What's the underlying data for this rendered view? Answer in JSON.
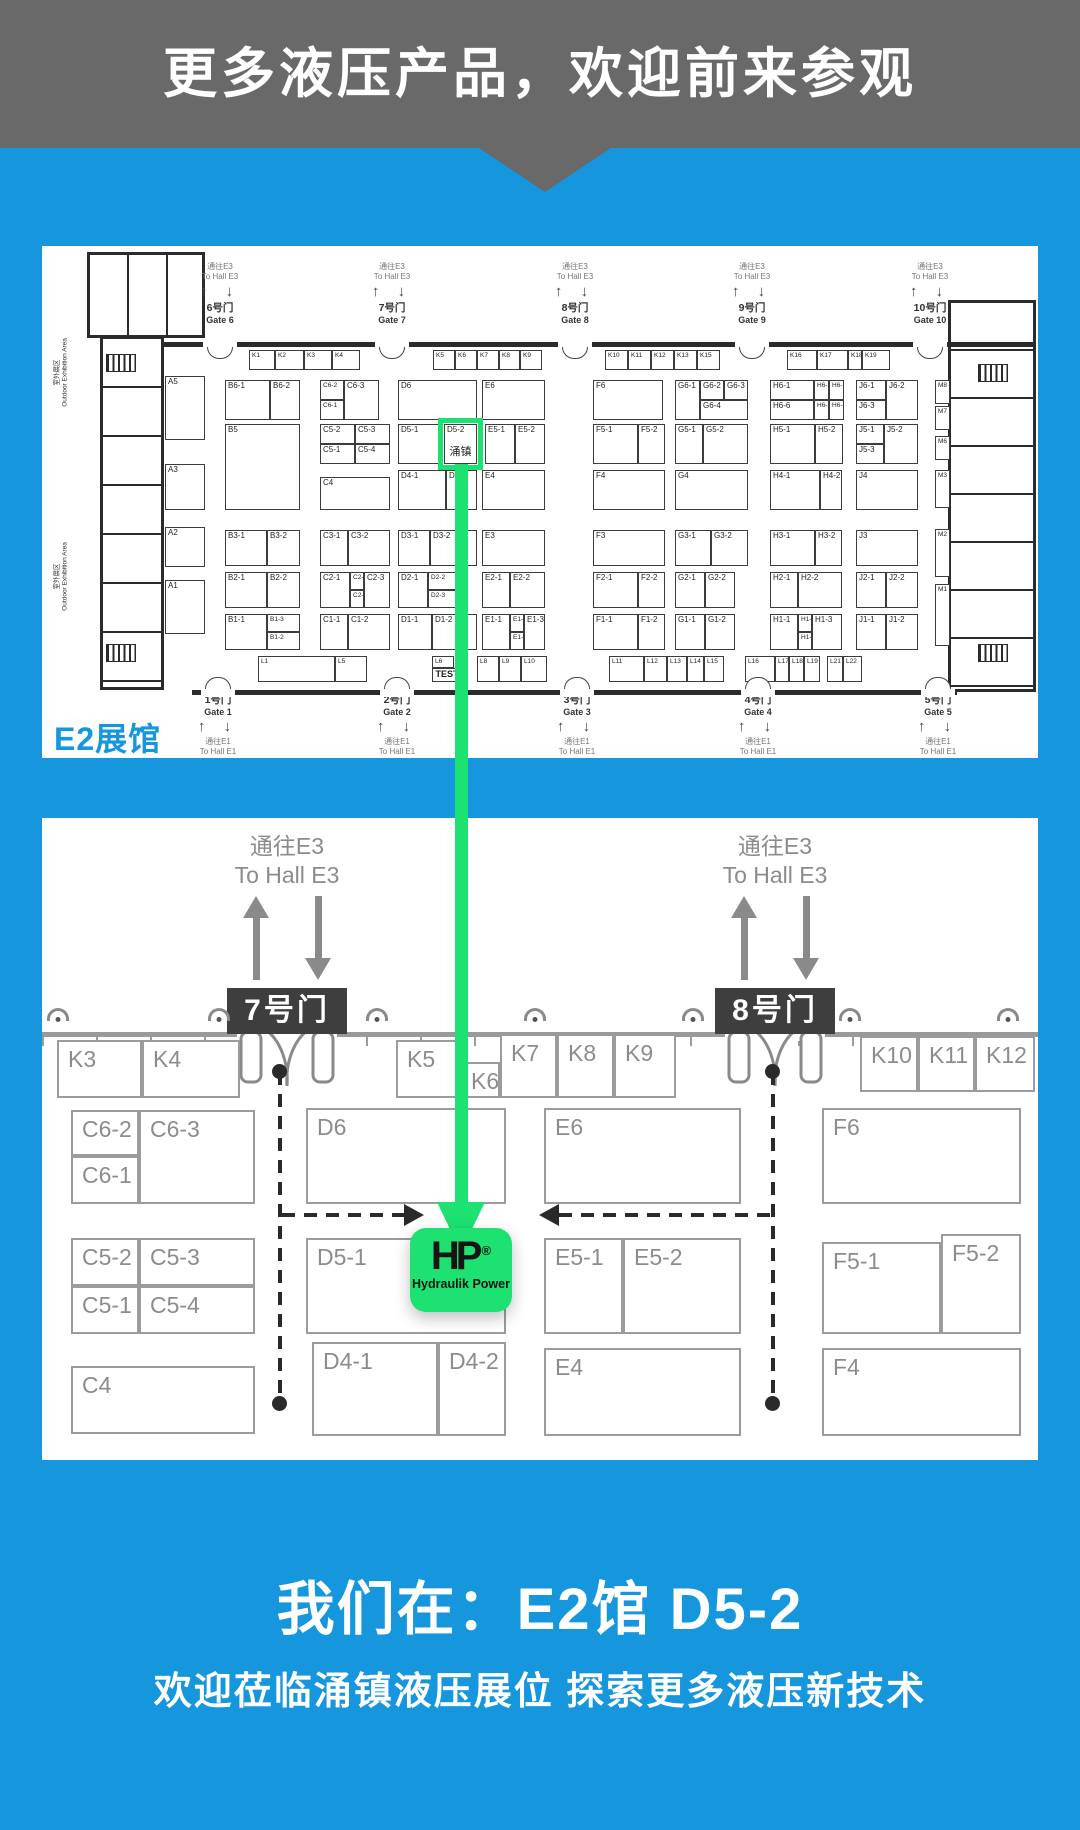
{
  "colors": {
    "blue": "#1596DD",
    "gray": "#696969",
    "green": "#1DE171",
    "dark": "#3E3E3E"
  },
  "banner": {
    "title": "更多液压产品，欢迎前来参观"
  },
  "footer": {
    "line1": "我们在：E2馆 D5-2",
    "line2": "欢迎莅临涌镇液压展位  探索更多液压新技术"
  },
  "booth_format": "label,x,y,w,h,class,sublabel",
  "hall_map": {
    "hall_label": "E2展馆",
    "outdoor": {
      "cn": "室外展区",
      "en": "Outdoor Exhibition Area"
    },
    "to_hall_top": {
      "cn": "通往E3",
      "en": "To Hall E3"
    },
    "to_hall_bottom": {
      "cn": "通往E1",
      "en": "To Hall E1"
    },
    "gates_top": [
      {
        "cn": "6号门",
        "en": "Gate 6",
        "x": 178
      },
      {
        "cn": "7号门",
        "en": "Gate 7",
        "x": 350
      },
      {
        "cn": "8号门",
        "en": "Gate 8",
        "x": 533
      },
      {
        "cn": "9号门",
        "en": "Gate 9",
        "x": 710
      },
      {
        "cn": "10号门",
        "en": "Gate 10",
        "x": 888
      }
    ],
    "gates_bottom": [
      {
        "cn": "1号门",
        "en": "Gate 1",
        "x": 176
      },
      {
        "cn": "2号门",
        "en": "Gate 2",
        "x": 355
      },
      {
        "cn": "3号门",
        "en": "Gate 3",
        "x": 535
      },
      {
        "cn": "4号门",
        "en": "Gate 4",
        "x": 716
      },
      {
        "cn": "5号门",
        "en": "Gate 5",
        "x": 896
      }
    ],
    "booths": [
      [
        "A5",
        123,
        130,
        40,
        64
      ],
      [
        "A3",
        123,
        218,
        40,
        46
      ],
      [
        "A2",
        123,
        281,
        40,
        40
      ],
      [
        "A1",
        123,
        334,
        40,
        54
      ],
      [
        "B6-1",
        183,
        134,
        45,
        40
      ],
      [
        "B6-2",
        228,
        134,
        30,
        40
      ],
      [
        "B5",
        183,
        178,
        75,
        86
      ],
      [
        "B3-1",
        183,
        284,
        42,
        36
      ],
      [
        "B3-2",
        225,
        284,
        33,
        36
      ],
      [
        "B2-1",
        183,
        326,
        42,
        36
      ],
      [
        "B2-2",
        225,
        326,
        33,
        36
      ],
      [
        "B1-1",
        183,
        368,
        42,
        36
      ],
      [
        "B1-3",
        225,
        368,
        33,
        18,
        "s"
      ],
      [
        "B1-2",
        225,
        386,
        33,
        18,
        "s"
      ],
      [
        "C6-2",
        278,
        134,
        24,
        20,
        "s"
      ],
      [
        "C6-1",
        278,
        154,
        24,
        20,
        "s"
      ],
      [
        "C6-3",
        302,
        134,
        35,
        40
      ],
      [
        "C5-2",
        278,
        178,
        35,
        20
      ],
      [
        "C5-3",
        313,
        178,
        35,
        20
      ],
      [
        "C5-1",
        278,
        198,
        35,
        20
      ],
      [
        "C5-4",
        313,
        198,
        35,
        20
      ],
      [
        "C4",
        278,
        231,
        70,
        33
      ],
      [
        "C3-1",
        278,
        284,
        28,
        36
      ],
      [
        "C3-2",
        306,
        284,
        42,
        36
      ],
      [
        "C2-1",
        278,
        326,
        30,
        36
      ],
      [
        "C2-4",
        308,
        326,
        14,
        18,
        "s"
      ],
      [
        "C2-2",
        308,
        344,
        14,
        18,
        "s"
      ],
      [
        "C2-3",
        322,
        326,
        26,
        36
      ],
      [
        "C1-1",
        278,
        368,
        28,
        36
      ],
      [
        "C1-2",
        306,
        368,
        42,
        36
      ],
      [
        "D6",
        356,
        134,
        79,
        40
      ],
      [
        "D5-1",
        356,
        178,
        44,
        40
      ],
      [
        "D5-2",
        402,
        178,
        33,
        40,
        "hl",
        "涌镇"
      ],
      [
        "D4-1",
        356,
        224,
        48,
        40
      ],
      [
        "D4-2",
        404,
        224,
        31,
        40
      ],
      [
        "D3-1",
        356,
        284,
        32,
        36
      ],
      [
        "D3-2",
        388,
        284,
        47,
        36
      ],
      [
        "D2-1",
        356,
        326,
        30,
        36
      ],
      [
        "D2-2",
        386,
        326,
        28,
        18,
        "s"
      ],
      [
        "D2-3",
        386,
        344,
        28,
        18,
        "s"
      ],
      [
        "D1-1",
        356,
        368,
        34,
        36
      ],
      [
        "D1-2",
        390,
        368,
        45,
        36
      ],
      [
        "E6",
        440,
        134,
        63,
        40
      ],
      [
        "E5-1",
        443,
        178,
        30,
        40
      ],
      [
        "E5-2",
        473,
        178,
        30,
        40
      ],
      [
        "E4",
        440,
        224,
        63,
        40
      ],
      [
        "E3",
        440,
        284,
        63,
        36
      ],
      [
        "E2-1",
        440,
        326,
        28,
        36
      ],
      [
        "E2-2",
        468,
        326,
        35,
        36
      ],
      [
        "E1-1",
        440,
        368,
        28,
        36
      ],
      [
        "E1-2",
        468,
        368,
        14,
        18,
        "s"
      ],
      [
        "E1-4",
        468,
        386,
        14,
        18,
        "s"
      ],
      [
        "E1-3",
        482,
        368,
        21,
        36
      ],
      [
        "F6",
        551,
        134,
        70,
        40
      ],
      [
        "F5-1",
        551,
        178,
        45,
        40
      ],
      [
        "F5-2",
        596,
        178,
        27,
        40
      ],
      [
        "F4",
        551,
        224,
        72,
        40
      ],
      [
        "F3",
        551,
        284,
        72,
        36
      ],
      [
        "F2-1",
        551,
        326,
        45,
        36
      ],
      [
        "F2-2",
        596,
        326,
        27,
        36
      ],
      [
        "F1-1",
        551,
        368,
        45,
        36
      ],
      [
        "F1-2",
        596,
        368,
        27,
        36
      ],
      [
        "G6-1",
        633,
        134,
        25,
        40
      ],
      [
        "G6-2",
        658,
        134,
        24,
        20
      ],
      [
        "G6-3",
        682,
        134,
        24,
        20
      ],
      [
        "G6-4",
        658,
        154,
        48,
        20
      ],
      [
        "G5-1",
        633,
        178,
        28,
        40
      ],
      [
        "G5-2",
        661,
        178,
        45,
        40
      ],
      [
        "G4",
        633,
        224,
        73,
        40
      ],
      [
        "G3-1",
        633,
        284,
        36,
        36
      ],
      [
        "G3-2",
        669,
        284,
        37,
        36
      ],
      [
        "G2-1",
        633,
        326,
        30,
        36
      ],
      [
        "G2-2",
        663,
        326,
        30,
        36
      ],
      [
        "G1-1",
        633,
        368,
        30,
        36
      ],
      [
        "G1-2",
        663,
        368,
        30,
        36
      ],
      [
        "H6-1",
        728,
        134,
        44,
        20
      ],
      [
        "H6-6",
        728,
        154,
        44,
        20
      ],
      [
        "H6-2",
        772,
        134,
        15,
        20,
        "s"
      ],
      [
        "H6-3",
        787,
        134,
        15,
        20,
        "s"
      ],
      [
        "H6-5",
        772,
        154,
        15,
        20,
        "s"
      ],
      [
        "H6-4",
        787,
        154,
        15,
        20,
        "s"
      ],
      [
        "H5-1",
        728,
        178,
        45,
        40
      ],
      [
        "H5-2",
        773,
        178,
        28,
        40
      ],
      [
        "H4-1",
        728,
        224,
        50,
        40
      ],
      [
        "H4-2",
        778,
        224,
        22,
        40
      ],
      [
        "H3-1",
        728,
        284,
        45,
        36
      ],
      [
        "H3-2",
        773,
        284,
        27,
        36
      ],
      [
        "H2-1",
        728,
        326,
        28,
        36
      ],
      [
        "H2-2",
        756,
        326,
        44,
        36
      ],
      [
        "H1-1",
        728,
        368,
        28,
        36
      ],
      [
        "H1-2",
        756,
        368,
        14,
        18,
        "s"
      ],
      [
        "H1-4",
        756,
        386,
        14,
        18,
        "s"
      ],
      [
        "H1-3",
        770,
        368,
        30,
        36
      ],
      [
        "J6-1",
        814,
        134,
        30,
        20
      ],
      [
        "J6-3",
        814,
        154,
        30,
        20
      ],
      [
        "J6-2",
        844,
        134,
        32,
        40
      ],
      [
        "J5-1",
        814,
        178,
        28,
        20
      ],
      [
        "J5-3",
        814,
        198,
        28,
        20
      ],
      [
        "J5-2",
        842,
        178,
        34,
        40
      ],
      [
        "J4",
        814,
        224,
        62,
        40
      ],
      [
        "J3",
        814,
        284,
        62,
        36
      ],
      [
        "J2-1",
        814,
        326,
        30,
        36
      ],
      [
        "J2-2",
        844,
        326,
        32,
        36
      ],
      [
        "J1-1",
        814,
        368,
        30,
        36
      ],
      [
        "J1-2",
        844,
        368,
        32,
        36
      ],
      [
        "M8",
        893,
        134,
        15,
        24,
        "s"
      ],
      [
        "M7",
        893,
        160,
        15,
        24,
        "s"
      ],
      [
        "M6",
        893,
        190,
        15,
        24,
        "s"
      ],
      [
        "M3",
        893,
        224,
        15,
        38,
        "s"
      ],
      [
        "M2",
        893,
        283,
        15,
        48,
        "s"
      ],
      [
        "M1",
        893,
        338,
        15,
        62,
        "s"
      ],
      [
        "K1",
        207,
        104,
        26,
        20,
        "s"
      ],
      [
        "K2",
        233,
        104,
        29,
        20,
        "s"
      ],
      [
        "K3",
        262,
        104,
        28,
        20,
        "s"
      ],
      [
        "K4",
        290,
        104,
        28,
        20,
        "s"
      ],
      [
        "K5",
        391,
        104,
        22,
        20,
        "s"
      ],
      [
        "K6",
        413,
        104,
        22,
        20,
        "s"
      ],
      [
        "K7",
        435,
        104,
        22,
        20,
        "s"
      ],
      [
        "K8",
        457,
        104,
        21,
        20,
        "s"
      ],
      [
        "K9",
        478,
        104,
        22,
        20,
        "s"
      ],
      [
        "K10",
        563,
        104,
        23,
        20,
        "s"
      ],
      [
        "K11",
        586,
        104,
        23,
        20,
        "s"
      ],
      [
        "K12",
        609,
        104,
        23,
        20,
        "s"
      ],
      [
        "K13",
        632,
        104,
        23,
        20,
        "s"
      ],
      [
        "K15",
        655,
        104,
        23,
        20,
        "s"
      ],
      [
        "K16",
        745,
        104,
        30,
        20,
        "s"
      ],
      [
        "K17",
        775,
        104,
        31,
        20,
        "s"
      ],
      [
        "K18",
        806,
        104,
        14,
        20,
        "s"
      ],
      [
        "K19",
        820,
        104,
        28,
        20,
        "s"
      ],
      [
        "L1",
        216,
        410,
        77,
        26,
        "s"
      ],
      [
        "L5",
        293,
        410,
        32,
        26,
        "s"
      ],
      [
        "L6",
        390,
        410,
        22,
        12,
        "s"
      ],
      [
        "TEST",
        390,
        422,
        30,
        14,
        "test"
      ],
      [
        "L8",
        435,
        410,
        22,
        26,
        "s"
      ],
      [
        "L9",
        457,
        410,
        22,
        26,
        "s"
      ],
      [
        "L10",
        479,
        410,
        26,
        26,
        "s"
      ],
      [
        "L11",
        567,
        410,
        35,
        26,
        "s"
      ],
      [
        "L12",
        602,
        410,
        23,
        26,
        "s"
      ],
      [
        "L13",
        625,
        410,
        20,
        26,
        "s"
      ],
      [
        "L14",
        645,
        410,
        17,
        26,
        "s"
      ],
      [
        "L15",
        662,
        410,
        20,
        26,
        "s"
      ],
      [
        "L16",
        703,
        410,
        30,
        26,
        "s"
      ],
      [
        "L17",
        733,
        410,
        14,
        26,
        "s"
      ],
      [
        "L18",
        747,
        410,
        15,
        26,
        "s"
      ],
      [
        "L19",
        762,
        410,
        16,
        26,
        "s"
      ],
      [
        "L21",
        785,
        410,
        16,
        26,
        "s"
      ],
      [
        "L22",
        801,
        410,
        19,
        26,
        "s"
      ]
    ]
  },
  "detail_map": {
    "to_hall": {
      "cn": "通往E3",
      "en": "To Hall E3"
    },
    "gates": [
      {
        "label": "7号门",
        "x": 245
      },
      {
        "label": "8号门",
        "x": 733
      }
    ],
    "camera_positions": [
      16,
      177,
      335,
      493,
      651,
      808,
      966
    ],
    "logo": {
      "mark": "HP",
      "reg": "®",
      "name": "Hydraulik Power"
    },
    "booths": [
      [
        "K3",
        15,
        222,
        85,
        58
      ],
      [
        "K4",
        100,
        222,
        98,
        58
      ],
      [
        "K5",
        354,
        222,
        64,
        58
      ],
      [
        "K6",
        418,
        244,
        40,
        36
      ],
      [
        "K7",
        458,
        216,
        57,
        64
      ],
      [
        "K8",
        515,
        216,
        57,
        64
      ],
      [
        "K9",
        572,
        216,
        62,
        64
      ],
      [
        "K10",
        818,
        218,
        58,
        56
      ],
      [
        "K11",
        876,
        218,
        57,
        56
      ],
      [
        "K12",
        933,
        218,
        60,
        56
      ],
      [
        "C6-2",
        29,
        292,
        68,
        46
      ],
      [
        "C6-1",
        29,
        338,
        68,
        48
      ],
      [
        "C6-3",
        97,
        292,
        116,
        94
      ],
      [
        "D6",
        264,
        290,
        200,
        96
      ],
      [
        "E6",
        502,
        290,
        197,
        96
      ],
      [
        "F6",
        780,
        290,
        199,
        96
      ],
      [
        "C5-2",
        29,
        420,
        68,
        48
      ],
      [
        "C5-3",
        97,
        420,
        116,
        48
      ],
      [
        "C5-1",
        29,
        468,
        68,
        48
      ],
      [
        "C5-4",
        97,
        468,
        116,
        48
      ],
      [
        "D5-1",
        264,
        420,
        200,
        96
      ],
      [
        "E5-1",
        502,
        420,
        79,
        96
      ],
      [
        "E5-2",
        581,
        420,
        118,
        96
      ],
      [
        "F5-1",
        780,
        424,
        119,
        92
      ],
      [
        "F5-2",
        899,
        416,
        80,
        100
      ],
      [
        "C4",
        29,
        548,
        184,
        68
      ],
      [
        "D4-1",
        270,
        524,
        126,
        94
      ],
      [
        "D4-2",
        396,
        524,
        68,
        94
      ],
      [
        "E4",
        502,
        530,
        197,
        88
      ],
      [
        "F4",
        780,
        530,
        199,
        88
      ]
    ]
  }
}
